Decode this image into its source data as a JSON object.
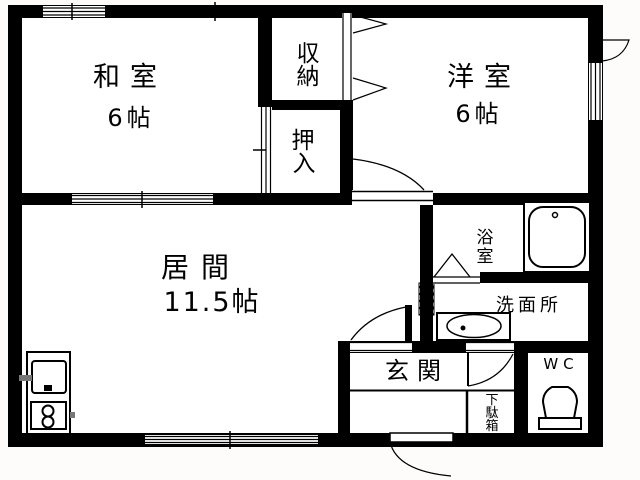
{
  "floorplan": {
    "rooms": {
      "washitsu": {
        "label": "和室",
        "size": "6帖"
      },
      "shuunou": {
        "chars": [
          "収",
          "納"
        ]
      },
      "oshiire": {
        "chars": [
          "押",
          "入"
        ]
      },
      "youshitsu": {
        "label": "洋室",
        "size": "6帖"
      },
      "ima": {
        "label": "居間",
        "size": "11.5帖"
      },
      "yokushitsu": {
        "chars": [
          "浴",
          "室"
        ]
      },
      "senmenjo": {
        "label": "洗面所"
      },
      "wc": {
        "label": "WC"
      },
      "genkan": {
        "label": "玄関"
      },
      "getabako": {
        "chars": [
          "下",
          "駄",
          "箱"
        ]
      }
    },
    "colors": {
      "wall": "#000000",
      "floor": "#ffffff",
      "background": "#fdfcfa",
      "line": "#000000"
    }
  }
}
